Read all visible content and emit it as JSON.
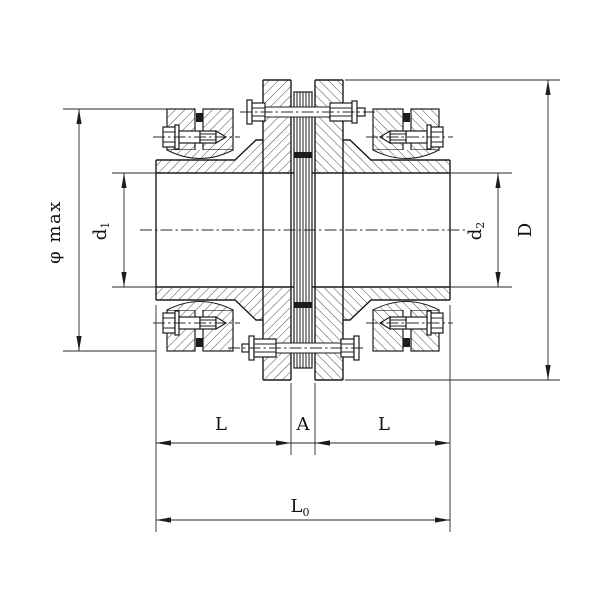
{
  "drawing": {
    "type": "coupling-sectional-drawing",
    "colors": {
      "background": "#ffffff",
      "line": "#1c1c1c",
      "hatch": "#3a3a3a",
      "dim_line": "#2a2a2a",
      "text": "#111111"
    },
    "dimension_labels": {
      "phi_max": "φ max",
      "d1_base": "d",
      "d1_sub": "1",
      "d2_base": "d",
      "d2_sub": "2",
      "D": "D",
      "L_left": "L",
      "A": "A",
      "L_right": "L",
      "L0_base": "L",
      "L0_sub": "0"
    }
  }
}
